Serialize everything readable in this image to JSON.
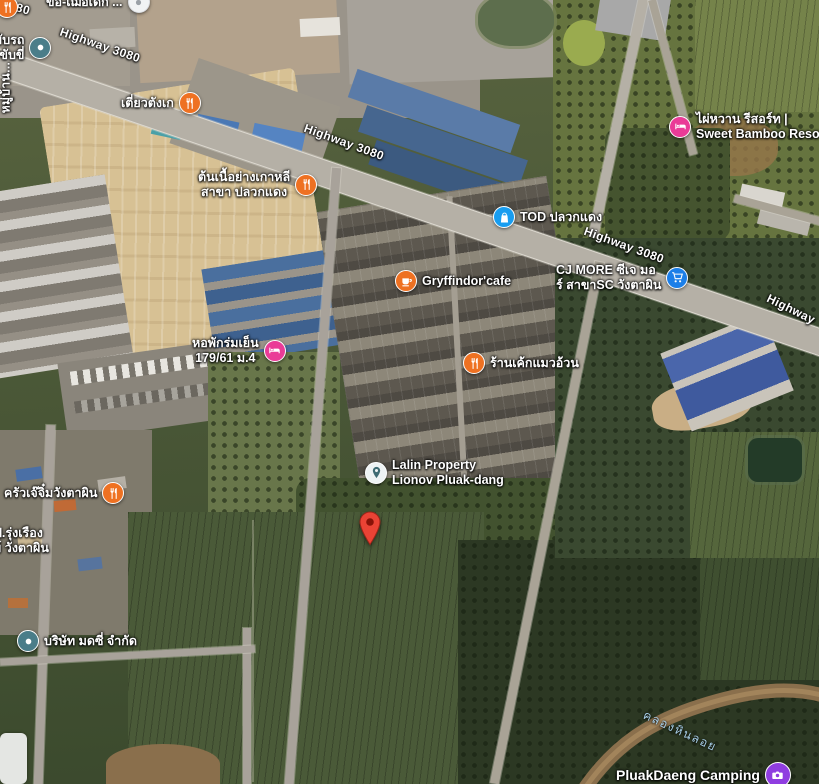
{
  "map": {
    "view_type": "satellite",
    "road_labels": {
      "hw1": "Highway 3080",
      "hw2": "Highway 3080",
      "hw3": "Highway 3080",
      "hw4": "Highway",
      "hw_fragment": "80"
    },
    "water_labels": {
      "canal": "คลองหินลอย"
    },
    "pois": {
      "tiaw": {
        "lines": [
          "เตี่ยวตังเก"
        ],
        "icon": "restaurant"
      },
      "korean": {
        "lines": [
          "ต้นเนื้อย่างเกาหลี",
          "สาขา ปลวกแดง"
        ],
        "icon": "restaurant"
      },
      "gryffindor": {
        "lines": [
          "Gryffindor'cafe"
        ],
        "icon": "cafe"
      },
      "cake": {
        "lines": [
          "ร้านเค้กแมวอ้วน"
        ],
        "icon": "restaurant"
      },
      "tod": {
        "lines": [
          "TOD ปลวกแดง"
        ],
        "icon": "shopping-bag"
      },
      "cj": {
        "lines": [
          "CJ MORE ซีเจ มอ",
          "ร์ สาขาSC วังตาผิน"
        ],
        "icon": "shopping-cart"
      },
      "bamboo": {
        "lines": [
          "ไผ่หวาน รีสอร์ท |",
          "Sweet Bamboo Resort |"
        ],
        "icon": "lodging"
      },
      "dorm": {
        "lines": [
          "หอพักร่มเย็น",
          "179/61 ม.4"
        ],
        "icon": "lodging"
      },
      "lalin": {
        "lines": [
          "Lalin Property",
          "Lionov Pluak-dang"
        ],
        "icon": "place-pin"
      },
      "kitchen": {
        "lines": [
          "ครัวเจ๊จิ๋มวังตาผิน"
        ],
        "icon": "restaurant"
      },
      "company": {
        "lines": [
          "บริษัท มดซี่ จำกัด"
        ],
        "icon": "place-dot"
      },
      "camping": {
        "lines": [
          "PluakDaeng Camping"
        ],
        "icon": "camera"
      },
      "driving": {
        "lines": [
          "สอนขับรถ",
          "าการขับขี่"
        ],
        "icon": "place-dot"
      },
      "rungrueang": {
        "lines": [
          "ป.รุ่งเรือง",
          "ย์ วังตาผิน"
        ],
        "icon": "none"
      },
      "top_partial": {
        "lines": [
          "ขอ-เฌอเด็ก ..."
        ],
        "icon": "white-circle"
      },
      "village_vertical": {
        "lines": [
          "หมู่บ้าน..."
        ],
        "icon": "none"
      }
    },
    "destination_pin": {
      "type": "red-map-pin",
      "label": ""
    },
    "colors": {
      "restaurant_orange": "#ee7122",
      "shopping_blue": "#189df0",
      "lodging_pink": "#ea3b97",
      "place_teal": "#4a7d89",
      "camping_purple": "#8f3de0",
      "destination_red": "#EA4335",
      "road_gray": "#b5b0a6",
      "water_label_blue": "#a8cfe8"
    }
  }
}
